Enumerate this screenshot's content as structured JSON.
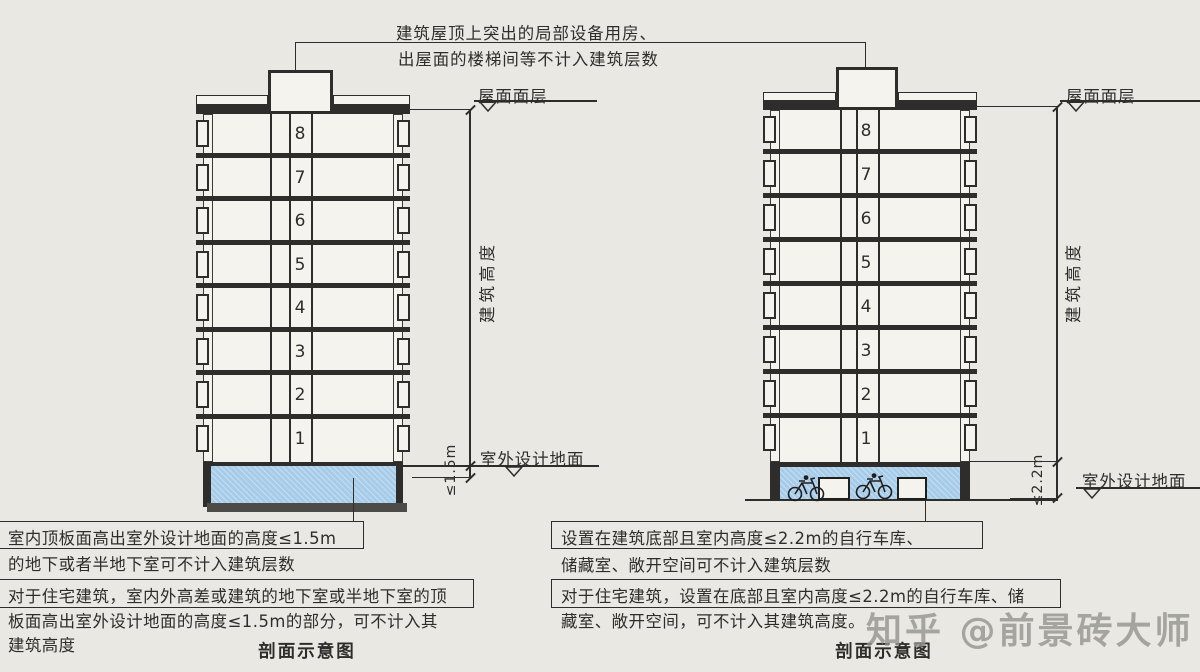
{
  "colors": {
    "ink": "#2e2d2b",
    "paper": "#e9e8e3",
    "building_fill": "#f4f3ee",
    "basement_blue": "#a6cce9",
    "foundation_gray": "#4c4b47",
    "watermark_gray": "#94938f"
  },
  "top_note": {
    "line1": "建筑屋顶上突出的局部设备用房、",
    "line2": "出屋面的楼梯间等不计入建筑层数"
  },
  "left": {
    "caption": "剖面示意图",
    "roof_label": "屋面面层",
    "height_label": "建筑高度",
    "ground_label": "室外设计地面",
    "basement_dim": "≤1.5m",
    "floors": [
      "8",
      "7",
      "6",
      "5",
      "4",
      "3",
      "2",
      "1"
    ],
    "note1": {
      "line1": "室内顶板面高出室外设计地面的高度≤1.5m",
      "line2": "的地下或者半地下室可不计入建筑层数"
    },
    "note2": {
      "line1": "对于住宅建筑，室内外高差或建筑的地下室或半地下室的顶",
      "line2": "板面高出室外设计地面的高度≤1.5m的部分，可不计入其",
      "line3": "建筑高度"
    }
  },
  "right": {
    "caption": "剖面示意图",
    "roof_label": "屋面面层",
    "height_label": "建筑高度",
    "ground_label": "室外设计地面",
    "basement_dim": "≤2.2m",
    "floors": [
      "8",
      "7",
      "6",
      "5",
      "4",
      "3",
      "2",
      "1"
    ],
    "note1": {
      "line1": "设置在建筑底部且室内高度≤2.2m的自行车库、",
      "line2": "储藏室、敞开空间可不计入建筑层数"
    },
    "note2": {
      "line1": "对于住宅建筑，设置在底部且室内高度≤2.2m的自行车库、储",
      "line2": "藏室、敞开空间，可不计入其建筑高度。"
    }
  },
  "watermark": {
    "text": "知乎 @前景砖大师"
  }
}
